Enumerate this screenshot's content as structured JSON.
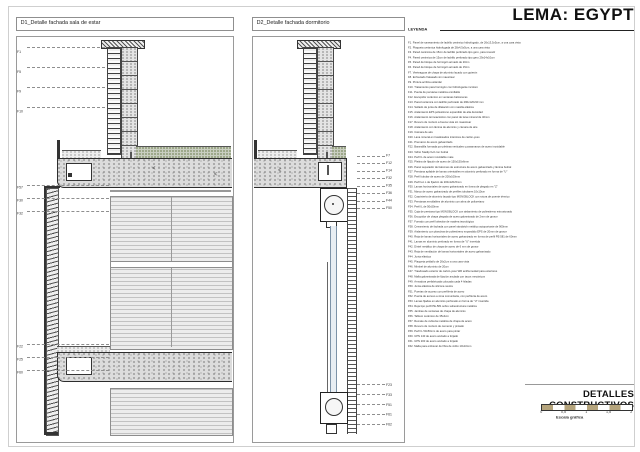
{
  "page": {
    "title": "LEMA: EGYPT"
  },
  "details": [
    {
      "id": "D1",
      "label": "D1_Detalle fachada sala de estar"
    },
    {
      "id": "D2",
      "label": "D2_Detalle fachada dormitorio"
    }
  ],
  "legend": {
    "title": "LEYENDA",
    "items": [
      {
        "c": "F1.",
        "t": "Panel de saneamiento de ladrillo cerámico hidrofugado, de 26x13,5x5cm, a una cara vista"
      },
      {
        "c": "F2.",
        "t": "Plaqueta cerámica hidrofugada de 28x4,5x5cm, a una cara vista"
      },
      {
        "c": "F3.",
        "t": "Pared cerámica de 15cm de ladrillo perforado tipo gero, para revestir"
      },
      {
        "c": "F4.",
        "t": "Pared cerámica de 15cm de ladrillo perforado tipo gero 29x14x10cm"
      },
      {
        "c": "F5.",
        "t": "Pared de bloque de hormigón armado de 20cm"
      },
      {
        "c": "F6.",
        "t": "Pared de bloque de hormigón armado de 15cm"
      },
      {
        "c": "F7.",
        "t": "Vierteaguas de chapa de aluminio lacado con goterón"
      },
      {
        "c": "F8.",
        "t": "Enfoscado fratasado sin maestrear"
      },
      {
        "c": "F9.",
        "t": "Pintura acrílica estándar"
      },
      {
        "c": "F10.",
        "t": "Tratamiento para hormigón con hidrofugante incoloro"
      },
      {
        "c": "F11.",
        "t": "Puerta de persiana metálica enrollable"
      },
      {
        "c": "F12.",
        "t": "Escupidor cerámico en ventanas balconeras"
      },
      {
        "c": "F13.",
        "t": "Pared cerámica con ladrillo perforado de 290x120x90 mm"
      },
      {
        "c": "F14.",
        "t": "Sellado de junta de dilatación con masilla elástica"
      },
      {
        "c": "F15.",
        "t": "Aislamiento EPS poliestireno expandido de alta densidad"
      },
      {
        "c": "F16.",
        "t": "Aislamiento termoacústico con panel de lana mineral de 40mm"
      },
      {
        "c": "F17.",
        "t": "Revoco de mortero a buena vista sin maestrear"
      },
      {
        "c": "F18.",
        "t": "Aislamiento con lámina de aluminio y cámara de aire"
      },
      {
        "c": "F19.",
        "t": "Cámara de aire"
      },
      {
        "c": "F20.",
        "t": "Lana mineral en trasdosados interiores de cartón-yeso"
      },
      {
        "c": "F21.",
        "t": "Premarco de acero galvanizado"
      },
      {
        "c": "F22.",
        "t": "Barandilla formada por pletinas verticales y pasamanos de acero inoxidable"
      },
      {
        "c": "F23.",
        "t": "Vidrio Stadip 6+6 con butiral"
      },
      {
        "c": "F24.",
        "t": "Perfil L de acero inoxidable mate"
      },
      {
        "c": "F25.",
        "t": "Pletina de fijación de acero de 150x150x6mm"
      },
      {
        "c": "F26.",
        "t": "Panel separador de balcones de estructura de acero galvanizado y lámina butiral"
      },
      {
        "c": "F27.",
        "t": "Persiana apilable de lamas orientables en aluminio perforado en forma de \"U\""
      },
      {
        "c": "F28.",
        "t": "Perfil tubular de acero de 200x100mm"
      },
      {
        "c": "F29.",
        "t": "Perfil en L de fijación de 200x120x5mm"
      },
      {
        "c": "F30.",
        "t": "Lamas horizontales de acero galvanizado en forma de plegado en \"Z\""
      },
      {
        "c": "F31.",
        "t": "Marco de acero galvanizado de perfiles tubulares 10x10cm"
      },
      {
        "c": "F32.",
        "t": "Carpintería de aluminio lacado tipo MONOBLOCK con rotura de puente térmico"
      },
      {
        "c": "F33.",
        "t": "Persianas enrollables de aluminio con alma de poliuretano"
      },
      {
        "c": "F34.",
        "t": "Perfil L de 50x50mm"
      },
      {
        "c": "F35.",
        "t": "Caja de persiana tipo MONOBLOCK con aislamiento de poliestireno extrusionado"
      },
      {
        "c": "F36.",
        "t": "Escupidor de chapa plegada de acero galvanizado de 2mm de grosor"
      },
      {
        "c": "F37.",
        "t": "Forrado con perfil alveolar de madera tecnológica"
      },
      {
        "c": "F38.",
        "t": "Cerramiento de fachada con panel sándwich metálico autoportante de 900mm"
      },
      {
        "c": "F39.",
        "t": "Aislamiento con planchas de poliestireno expandido EPS de 20mm de grosor"
      },
      {
        "c": "F40.",
        "t": "Reja de lamas horizontales de acero galvanizado en forma de perfil PE-581 de 60mm"
      },
      {
        "c": "F41.",
        "t": "Lamas en aluminio perforado en forma de \"U\" invertida"
      },
      {
        "c": "F42.",
        "t": "Dintel metálico de chapa de acero de 6 mm de grosor"
      },
      {
        "c": "F43.",
        "t": "Reja de ventilación de lamas horizontales de acero galvanizado"
      },
      {
        "c": "F44.",
        "t": "Junta elástica"
      },
      {
        "c": "F45.",
        "t": "Plaqueta peldaño de 26x2cm a una cara vista"
      },
      {
        "c": "F46.",
        "t": "Mimbel de aluminio de 20cm"
      },
      {
        "c": "F47.",
        "t": "Trasdosado exterior de cartón-yeso WR antihumedad para exteriores"
      },
      {
        "c": "F48.",
        "t": "Malla galvanizada de fijación anclada con tacos mecánicos"
      },
      {
        "c": "F49.",
        "t": "Armadura prefabricada colocada cada 4 hiladas"
      },
      {
        "c": "F50.",
        "t": "Junta elástica de silicona neutra"
      },
      {
        "c": "F51.",
        "t": "Puertas de acceso con perfilería de acero"
      },
      {
        "c": "F52.",
        "t": "Puerta de acceso a zona comunitaria, con perfilería de acero"
      },
      {
        "c": "F53.",
        "t": "Lamas fijadas en aluminio perforado en forma de \"U\" invertida"
      },
      {
        "c": "F54.",
        "t": "Reja tipo perfil PE-581 sobre subestructura metálica"
      },
      {
        "c": "F55.",
        "t": "Jambas de ventanas de chapa de aluminio"
      },
      {
        "c": "F56.",
        "t": "Tablero cerámico de 35x4cm"
      },
      {
        "c": "F57.",
        "t": "Remate de cubierta metálica de chapa de acero"
      },
      {
        "c": "F58.",
        "t": "Revoco de mortero de cemento y pintado"
      },
      {
        "c": "F59.",
        "t": "Perfil L 50x50mm de acero para pintar"
      },
      {
        "c": "F60.",
        "t": "UPN 140 de acero anclado a forjado"
      },
      {
        "c": "F61.",
        "t": "UPN 200 de acero anclado a forjado"
      },
      {
        "c": "F62.",
        "t": "Malla para enfoscar de fibra de vidrio 10x10mm"
      }
    ]
  },
  "d1_callouts": {
    "top": [
      "F1",
      "F5",
      "F9",
      "F10"
    ],
    "mid": [
      "F57",
      "F30",
      "F32"
    ],
    "bottom": [
      "F22",
      "F25",
      "F60"
    ]
  },
  "d2_callouts": {
    "top": [
      "F7",
      "F12",
      "F14",
      "F32",
      "F35",
      "F36",
      "F44",
      "F50"
    ],
    "bottom": [
      "F23",
      "F33",
      "F51",
      "F61",
      "F62"
    ]
  },
  "titleblock": {
    "title": "DETALLES CONSTRUCTIVOS",
    "scale_caption": "Escala gráfica",
    "scale_ticks": [
      "0",
      "0,5",
      "1",
      "1,5",
      "2"
    ]
  },
  "colors": {
    "scale_tan": "#b5a47c",
    "glazing_blue": "#7d93a8",
    "gravel_green": "#7f8e66",
    "line_dark": "#222222"
  }
}
